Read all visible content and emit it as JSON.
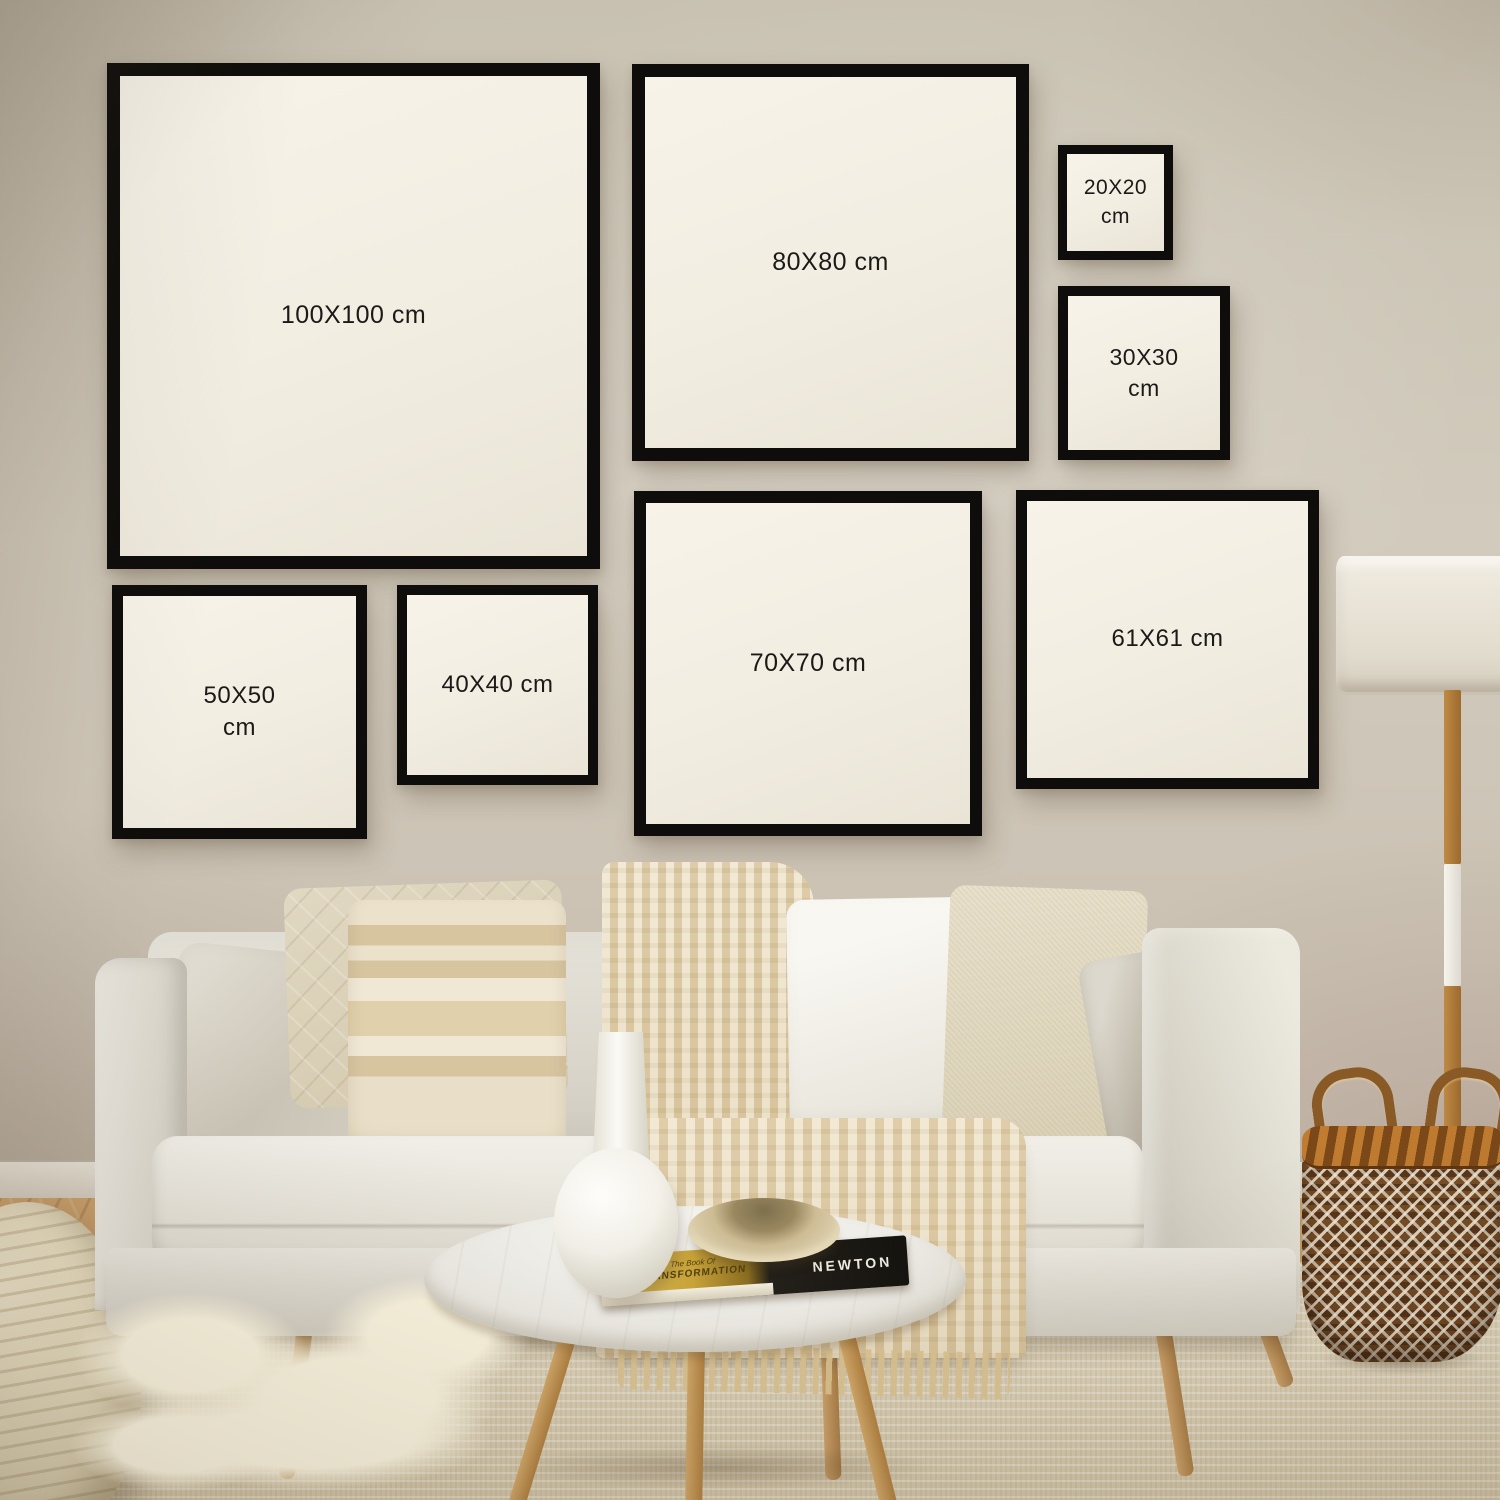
{
  "frames": [
    {
      "id": "100x100",
      "label": "100X100 cm"
    },
    {
      "id": "80x80",
      "label": "80X80 cm"
    },
    {
      "id": "20x20",
      "label": "20X20 cm"
    },
    {
      "id": "30x30",
      "label": "30X30 cm"
    },
    {
      "id": "50x50",
      "label": "50X50 cm"
    },
    {
      "id": "40x40",
      "label": "40X40 cm"
    },
    {
      "id": "70x70",
      "label": "70X70 cm"
    },
    {
      "id": "61x61",
      "label": "61X61 cm"
    }
  ],
  "book": {
    "cover_prefix": "The Book Of",
    "cover_title": "TRANSFORMATION",
    "spine_title": "NEWTON"
  },
  "colors": {
    "frame_border": "#0e0d0b",
    "frame_mat": "#f3efe4",
    "label_text": "#1b1a18",
    "wall": "#cfc8bb",
    "wood_floor": "#c09263",
    "rug": "#dcd2b9",
    "sofa": "#ddd9cf",
    "basket_brown": "#7a5028",
    "lamp_wood": "#b5813f"
  }
}
